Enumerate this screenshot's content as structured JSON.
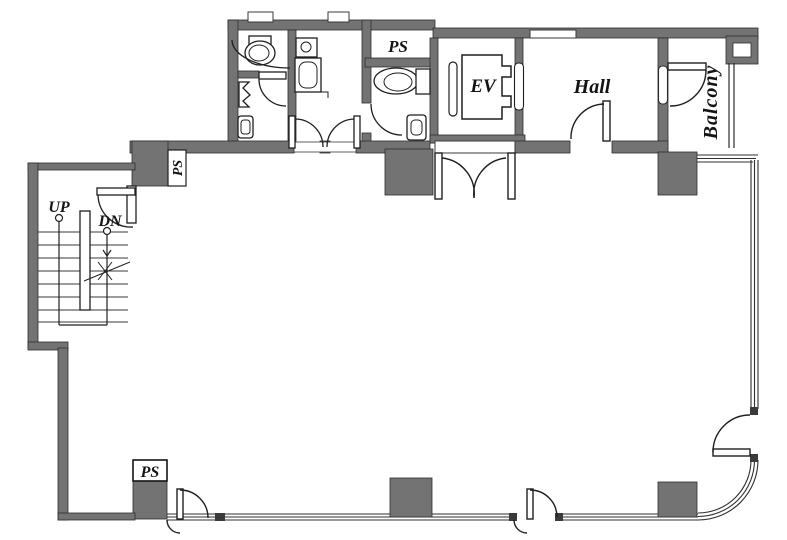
{
  "plan": {
    "labels": {
      "ps_top": "PS",
      "ps_stair": "PS",
      "ps_bottom": "PS",
      "elevator": "EV",
      "hall": "Hall",
      "balcony": "Balcony",
      "up": "UP",
      "down": "DN"
    },
    "colors": {
      "wall_fill": "#737373",
      "wall_edge": "#2d2d2d",
      "line": "#2b2b2b",
      "background": "#ffffff",
      "text": "#141414"
    }
  }
}
